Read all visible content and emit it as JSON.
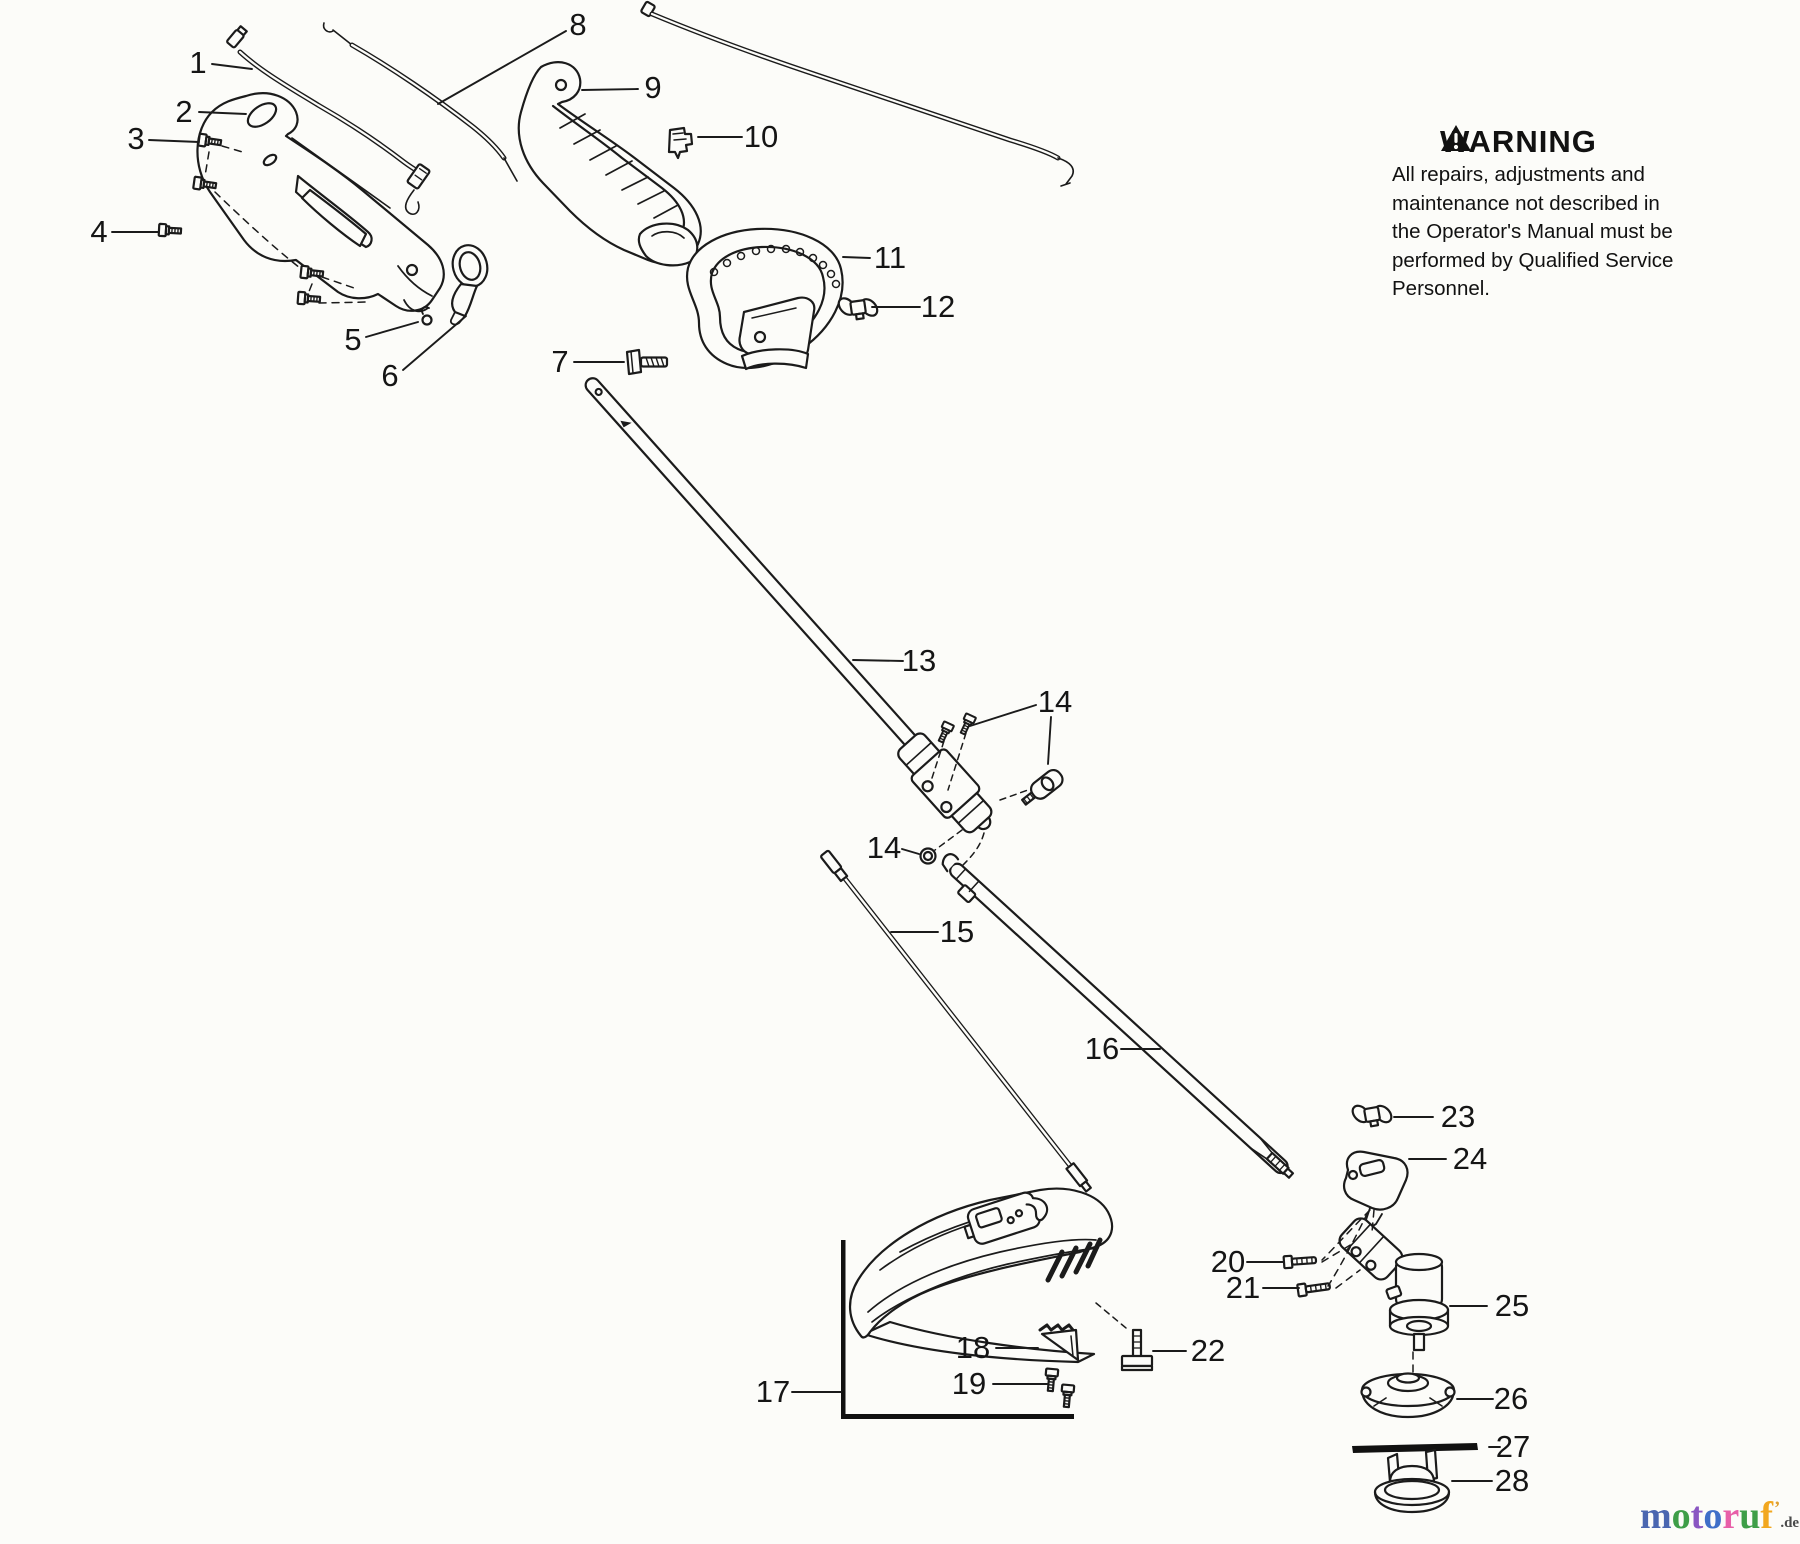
{
  "part_labels": [
    "1",
    "2",
    "3",
    "4",
    "5",
    "6",
    "7",
    "8",
    "9",
    "10",
    "11",
    "12",
    "13",
    "14",
    "14",
    "15",
    "16",
    "17",
    "18",
    "19",
    "20",
    "21",
    "22",
    "23",
    "24",
    "25",
    "26",
    "27",
    "28"
  ],
  "warning": {
    "title": "WARNING",
    "lines": [
      "All repairs, adjustments and",
      "maintenance not described in",
      "the Operator's Manual must be",
      "performed by Qualified Service",
      "Personnel."
    ]
  },
  "logo": {
    "letters": [
      {
        "ch": "m",
        "color": "#4a66b0"
      },
      {
        "ch": "o",
        "color": "#3e9e48"
      },
      {
        "ch": "t",
        "color": "#8a56c2"
      },
      {
        "ch": "o",
        "color": "#3f6fc8"
      },
      {
        "ch": "r",
        "color": "#e85fa8"
      },
      {
        "ch": "u",
        "color": "#3e9e48"
      },
      {
        "ch": "f",
        "color": "#f2a71f"
      }
    ],
    "tick": "’",
    "tick_color": "#e0a030",
    "suffix": ".de",
    "suffix_color": "#4a4a4a"
  }
}
